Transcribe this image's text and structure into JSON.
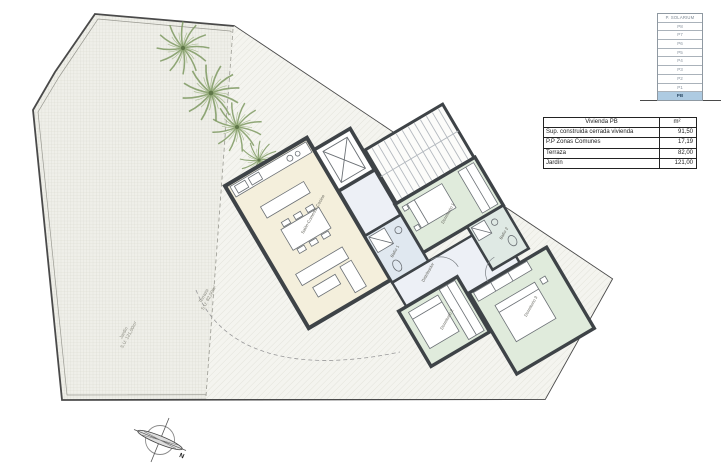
{
  "floor_stack": {
    "title": "P. SOLARIUM",
    "floors": [
      "P8",
      "P7",
      "P6",
      "P5",
      "P4",
      "P3",
      "P2",
      "P1",
      "PB"
    ],
    "active_floor": "PB",
    "active_color": "#aecbe2"
  },
  "area_table": {
    "header": {
      "name": "Vivienda PB",
      "unit": "m²"
    },
    "rows": [
      {
        "name": "Sup. construida cerrada vivienda",
        "value": "91,50"
      },
      {
        "name": "P.P Zonas Comunes",
        "value": "17,19"
      },
      {
        "name": "Terraza",
        "value": "82,00"
      },
      {
        "name": "Jardín",
        "value": "121,00"
      }
    ]
  },
  "plan": {
    "rooms": {
      "living": "Salón-Comedor-Cocina",
      "bedroom1": "Dormitorio 1",
      "bedroom2": "Dormitorio 2",
      "bedroom3": "Dormitorio 3",
      "bath1": "Baño 1",
      "bath2": "Baño 2",
      "hall": "Distribuidor"
    },
    "outdoor": {
      "terrace_label": "Terraza",
      "terrace_area": "S.U: 82,00m²",
      "garden_label": "Jardín",
      "garden_area": "S.U: 121,00m²"
    }
  },
  "compass": {
    "north_label": "N"
  },
  "colors": {
    "walls": "#3e4347",
    "living_fill": "#f4efdc",
    "bedroom_fill": "#e0ebdc",
    "bath_fill": "#e0e8f0",
    "hall_fill": "#edf0f6",
    "garden_hatch": "#d7d7cd",
    "terrace_hatch": "#dcdcd3",
    "tree_green": "#7f9a63",
    "active_floor_blue": "#aecbe2"
  }
}
